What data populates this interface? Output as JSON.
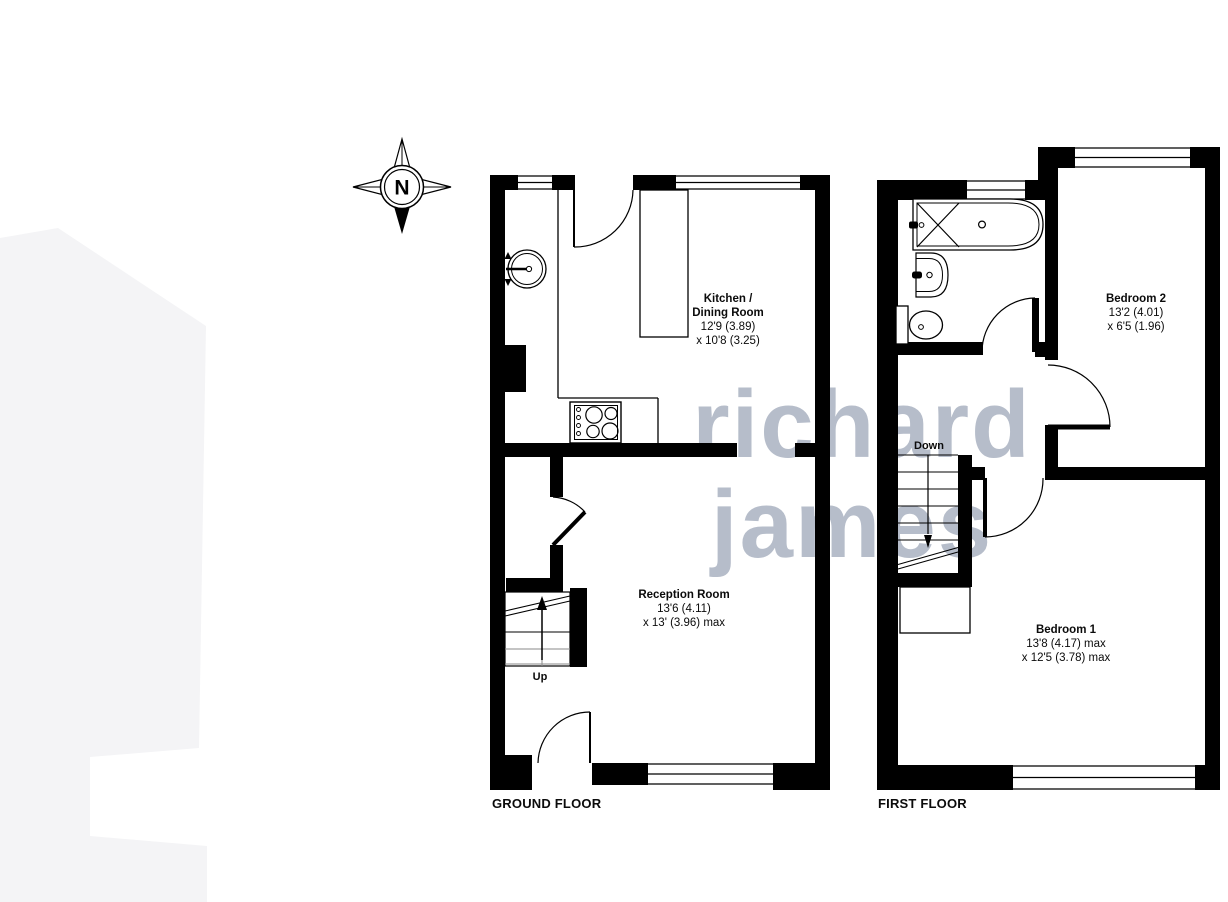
{
  "watermark": {
    "line1": "richard",
    "line2": "james"
  },
  "compass": {
    "label": "N"
  },
  "ground_floor": {
    "title": "GROUND FLOOR",
    "stairs_label": "Up",
    "kitchen": {
      "name1": "Kitchen /",
      "name2": "Dining Room",
      "dims1": "12'9 (3.89)",
      "dims2": "x 10'8 (3.25)"
    },
    "reception": {
      "name": "Reception Room",
      "dims1": "13'6 (4.11)",
      "dims2": "x 13' (3.96) max"
    }
  },
  "first_floor": {
    "title": "FIRST FLOOR",
    "stairs_label": "Down",
    "bedroom2": {
      "name": "Bedroom 2",
      "dims1": "13'2 (4.01)",
      "dims2": "x 6'5 (1.96)"
    },
    "bedroom1": {
      "name": "Bedroom 1",
      "dims1": "13'8 (4.17) max",
      "dims2": "x 12'5 (3.78) max"
    }
  },
  "colors": {
    "wall": "#000000",
    "watermark": "#b6bdca",
    "step_gray": "#8a8a8a",
    "left_shape": "#f4f4f6"
  }
}
